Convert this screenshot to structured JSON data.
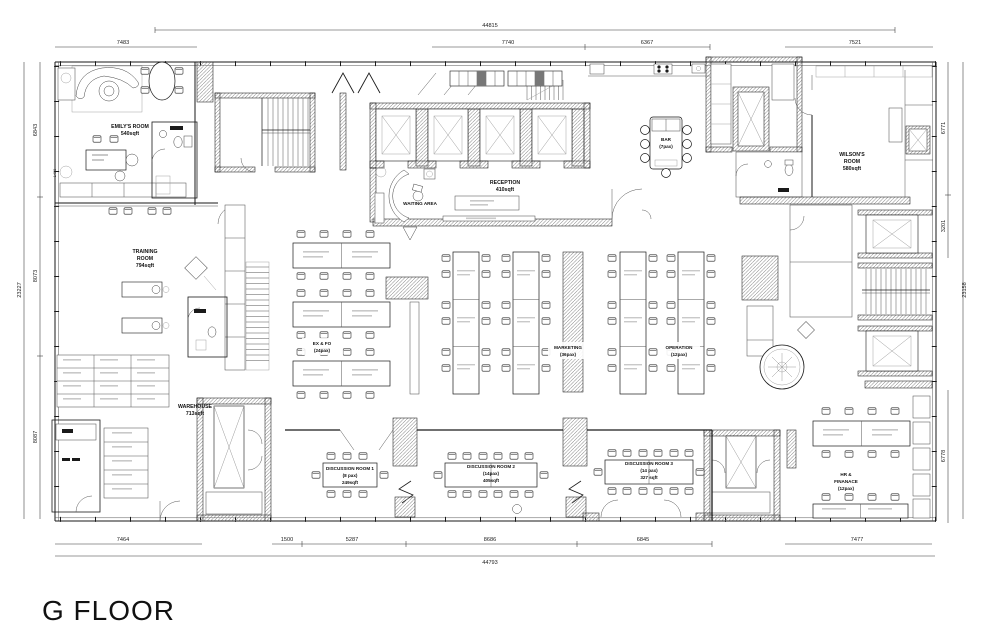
{
  "title": "G FLOOR",
  "colors": {
    "ink": "#1a1a1a",
    "wall_hatch": "#8a8a8a",
    "micro_detail": "#c9c9c9",
    "background": "#ffffff"
  },
  "dimensions": {
    "top": {
      "overall": "44815",
      "segments": [
        "7483",
        "7740",
        "6367",
        "7521"
      ]
    },
    "bottom": {
      "overall": "44793",
      "segments": [
        "7464",
        "1500",
        "5287",
        "8686",
        "6845",
        "7477"
      ]
    },
    "left": {
      "overall": "23227",
      "segments": [
        "6843",
        "8073",
        "8087"
      ]
    },
    "right": {
      "overall": "23158",
      "segments": [
        "6771",
        "3201",
        "6778"
      ]
    },
    "interior": {
      "emily_wall": "1400"
    }
  },
  "rooms": {
    "emily": {
      "name": "EMILY'S ROOM",
      "area": "540sqft"
    },
    "training": {
      "l1": "TRAINING",
      "l2": "ROOM",
      "l3": "794sqft"
    },
    "warehouse": {
      "name": "WAREHOUSE",
      "area": "713sqft"
    },
    "waiting": {
      "name": "WAITING AREA"
    },
    "reception": {
      "name": "RECEPTION",
      "area": "410sqft"
    },
    "bar": {
      "name": "BAR",
      "capacity": "(7pax)"
    },
    "wilson": {
      "l1": "WILSON'S",
      "l2": "ROOM",
      "l3": "580sqft"
    },
    "exfo": {
      "name": "EX & FO",
      "capacity": "(24pax)"
    },
    "marketing": {
      "name": "MARKETING",
      "capacity": "(36pax)"
    },
    "operation": {
      "name": "OPERATION",
      "capacity": "(12pax)"
    },
    "dr1": {
      "name": "DISCUSSION ROOM 1",
      "capacity": "(8 pax)",
      "area": "249sqft"
    },
    "dr2": {
      "name": "DISCUSSION ROOM 2",
      "capacity": "(14pax)",
      "area": "405sqft"
    },
    "dr3": {
      "name": "DISCUSSION ROOM 3",
      "capacity": "(14 pax)",
      "area": "327 sqft"
    },
    "hr": {
      "l1": "HR &",
      "l2": "FINANACE",
      "l3": "(12pax)"
    }
  }
}
